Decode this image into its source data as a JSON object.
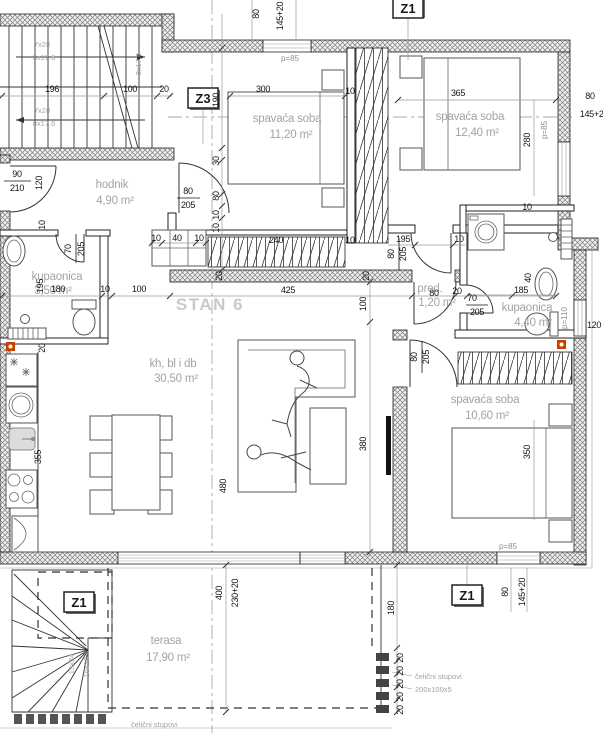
{
  "plan": {
    "unit_label": "STAN 6"
  },
  "rooms": [
    {
      "name": "hodnik",
      "area": "4,90 m²"
    },
    {
      "name": "spavaća soba",
      "area": "11,20 m²"
    },
    {
      "name": "spavaća soba",
      "area": "12,40 m²"
    },
    {
      "name": "kupaonica",
      "area": "3,50 m²"
    },
    {
      "name": "kh, bl i db",
      "area": "30,50 m²"
    },
    {
      "name": "pred.",
      "area": "1,20 m²"
    },
    {
      "name": "kupaonica",
      "area": "4,40 m²"
    },
    {
      "name": "spavaća soba",
      "area": "10,60 m²"
    },
    {
      "name": "terasa",
      "area": "17,90 m²"
    }
  ],
  "markers": {
    "z1": "Z1",
    "z3": "Z3"
  },
  "stairs": {
    "main_run_a": "7x28",
    "main_run_b": "8x17.6",
    "ext_run_a": "15x24",
    "ext_run_b": "16x19.4"
  },
  "windows": {
    "p85": "p=85",
    "p110": "p=110"
  },
  "notes": {
    "steel_columns": "čelični stupovi",
    "steel_columns_size": "200x100x5"
  },
  "dims": {
    "d10": "10",
    "d20": "20",
    "d30": "30",
    "d40": "40",
    "d70": "70",
    "d80": "80",
    "d90": "90",
    "d100": "100",
    "d120": "120",
    "d145": "145+20",
    "d180": "180",
    "d185": "185",
    "d190": "190",
    "d195": "195",
    "d196": "196",
    "d205": "205",
    "d210": "210",
    "d230": "230+20",
    "d240": "240",
    "d280": "280",
    "d300": "300",
    "d350": "350",
    "d355": "355",
    "d365": "365",
    "d380": "380",
    "d400": "400",
    "d425": "425",
    "d480": "480"
  }
}
